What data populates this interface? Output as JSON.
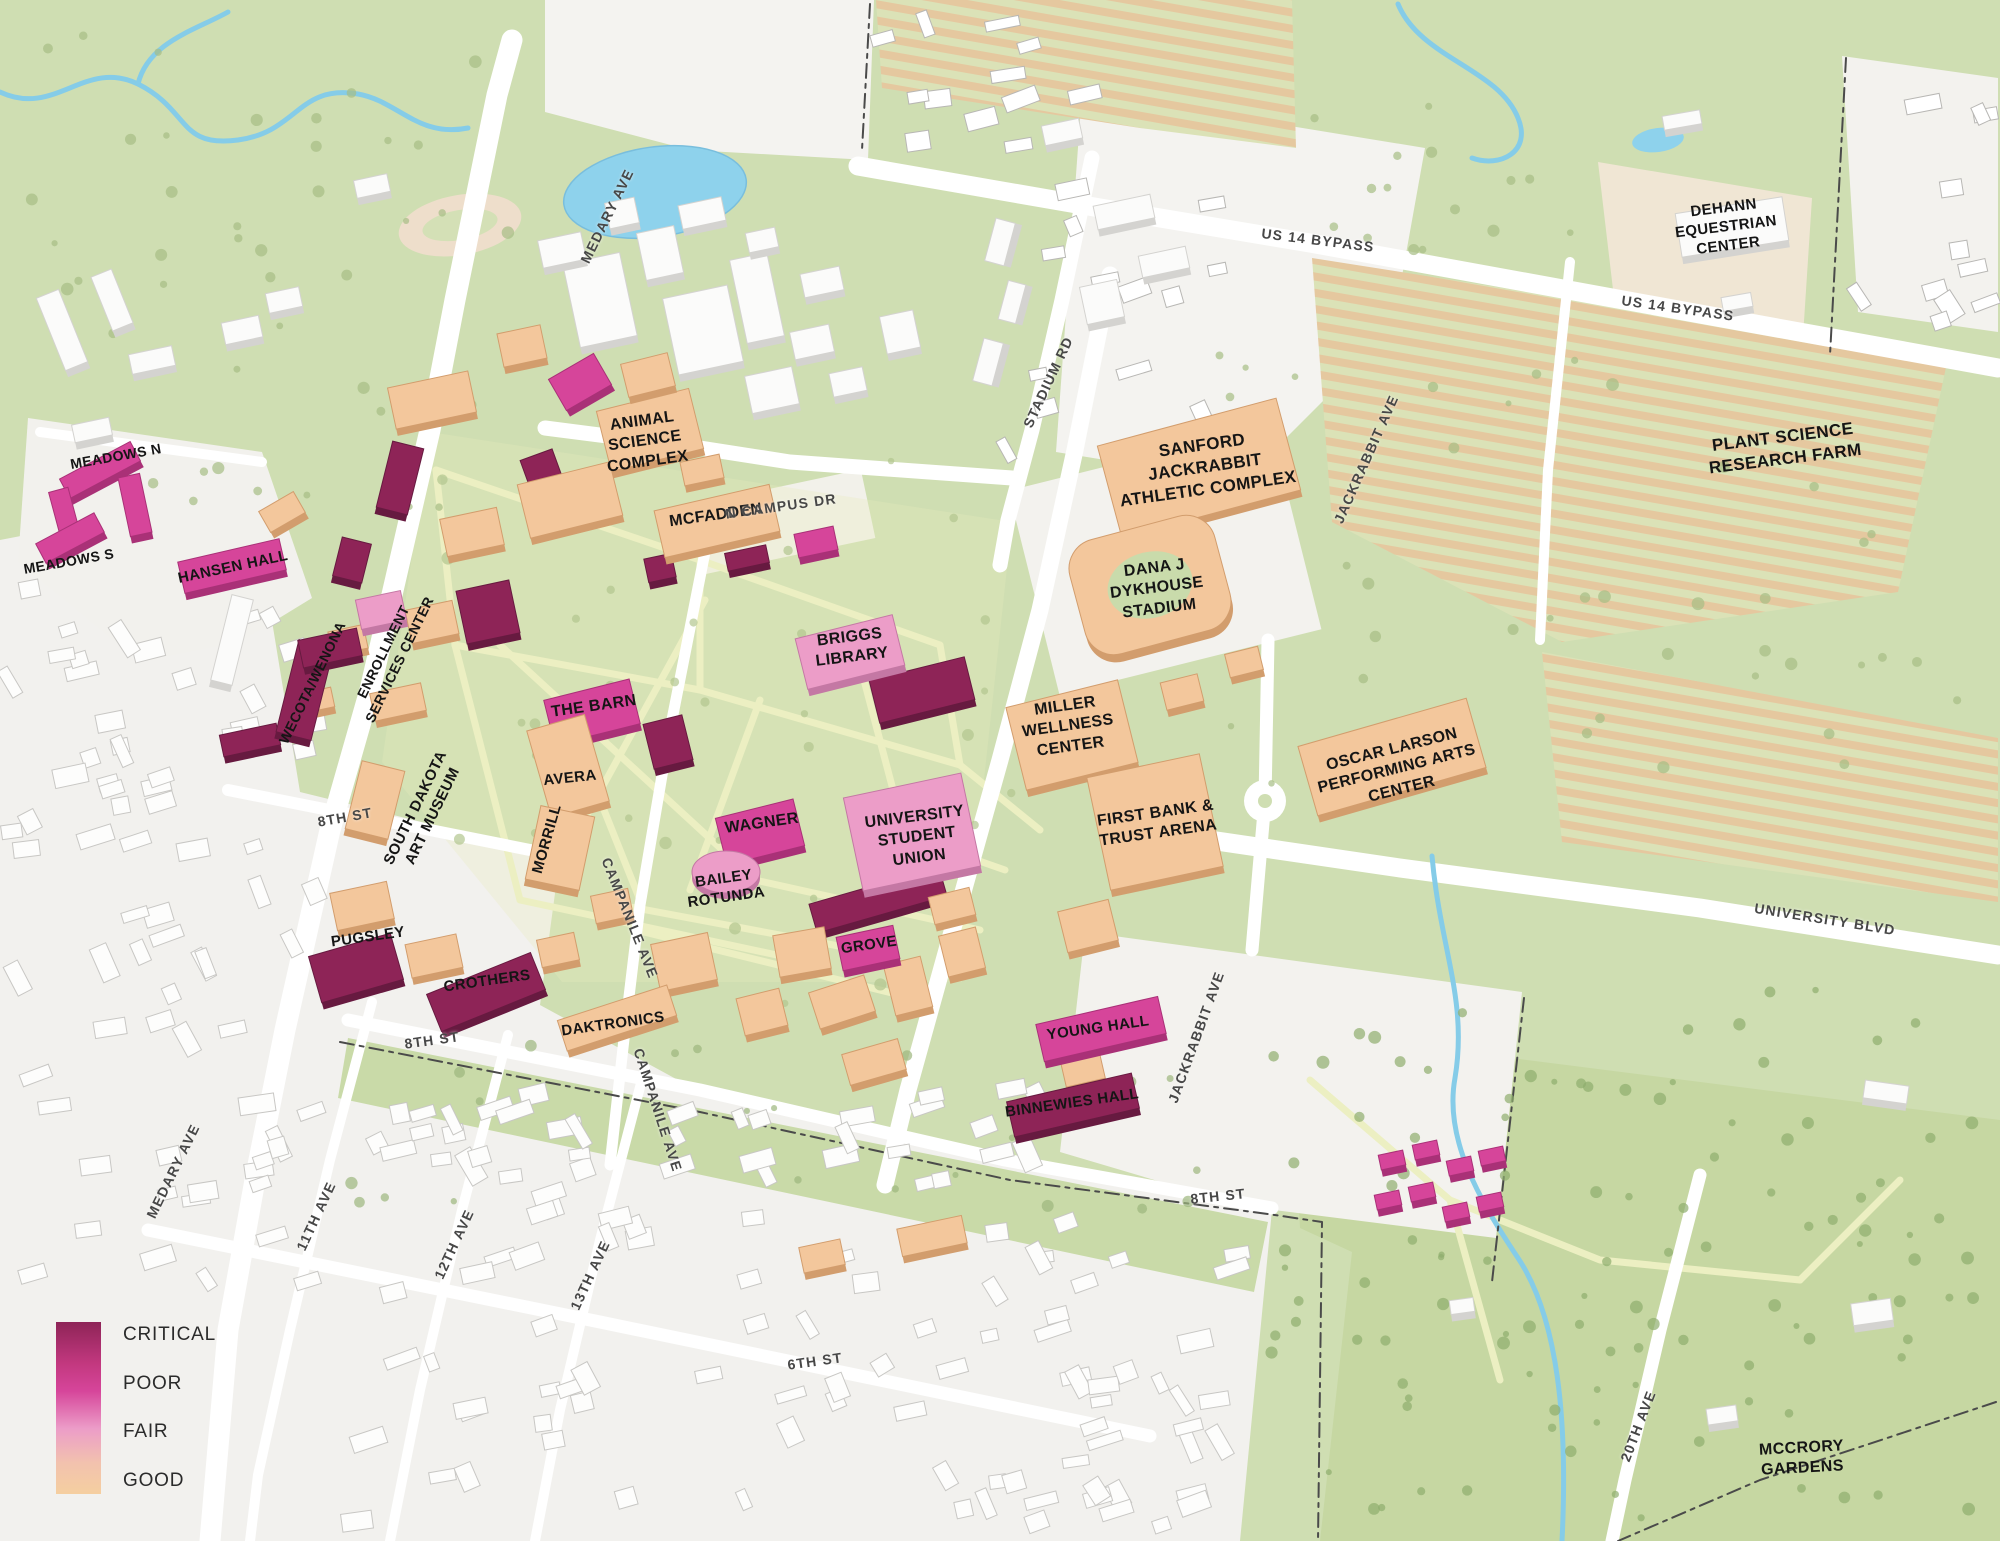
{
  "legend": {
    "items": [
      {
        "label": "CRITICAL",
        "color": "#8e2457"
      },
      {
        "label": "POOR",
        "color": "#d6459a"
      },
      {
        "label": "FAIR",
        "color": "#ec9dc8"
      },
      {
        "label": "GOOD",
        "color": "#f3c79c"
      }
    ]
  },
  "colors": {
    "critical": "#8e2457",
    "critical_side": "#671a40",
    "poor": "#d6459a",
    "poor_side": "#a93177",
    "fair": "#ec9dc8",
    "fair_side": "#c478a4",
    "good": "#f3c79c",
    "good_side": "#d29d6d",
    "white": "#fbfbfa",
    "white_side": "#d4d3d0",
    "map_green": "#cfdeb2",
    "mccrory": "#c6d7a2",
    "residential": "#f2f1ee",
    "water": "#8ed2ec",
    "road": "#ffffff",
    "path": "#ecefc2"
  },
  "buildings": [
    {
      "slug": "meadows-n",
      "label": "MEADOWS N",
      "condition": "poor",
      "label_x": 116,
      "label_y": 457,
      "label_rot": -10,
      "label_size": 14,
      "shapes": [
        [
          100,
          470,
          80,
          22,
          -28
        ],
        [
          135,
          505,
          22,
          60,
          -12
        ]
      ]
    },
    {
      "slug": "meadows-s",
      "label": "MEADOWS S",
      "condition": "poor",
      "label_x": 69,
      "label_y": 562,
      "label_rot": -10,
      "label_size": 14,
      "shapes": [
        [
          65,
          515,
          20,
          52,
          -15
        ],
        [
          70,
          538,
          66,
          22,
          -28
        ]
      ]
    },
    {
      "slug": "hansen-hall",
      "label": "HANSEN HALL",
      "condition": "poor",
      "label_x": 233,
      "label_y": 567,
      "label_rot": -12,
      "label_size": 15,
      "shapes": [
        [
          232,
          566,
          104,
          32,
          -13
        ]
      ]
    },
    {
      "slug": "wecota-wenona",
      "label": "WECOTA/WENONA",
      "condition": "critical",
      "label_x": 313,
      "label_y": 683,
      "label_rot": -64,
      "label_size": 14,
      "shapes": [
        [
          305,
          690,
          36,
          95,
          14
        ],
        [
          330,
          648,
          60,
          28,
          -12
        ]
      ]
    },
    {
      "slug": "enrollment-services-center",
      "label": "ENROLLMENT\nSERVICES CENTER",
      "condition": "fair",
      "label_x": 392,
      "label_y": 656,
      "label_rot": -64,
      "label_size": 14,
      "shapes": [
        [
          381,
          610,
          46,
          30,
          -12
        ]
      ]
    },
    {
      "slug": "south-dakota-art-museum",
      "label": "SOUTH DAKOTA\nART MUSEUM",
      "condition": "good",
      "label_x": 424,
      "label_y": 812,
      "label_rot": -64,
      "label_size": 15,
      "shapes": [
        [
          375,
          800,
          44,
          70,
          14
        ]
      ]
    },
    {
      "slug": "animal-science-complex",
      "label": "ANIMAL\nSCIENCE\nCOMPLEX",
      "condition": "good",
      "label_x": 645,
      "label_y": 442,
      "label_rot": -8,
      "label_size": 16,
      "shapes": [
        [
          650,
          430,
          95,
          62,
          -14
        ],
        [
          648,
          375,
          48,
          34,
          -14
        ],
        [
          570,
          500,
          95,
          55,
          -14
        ]
      ]
    },
    {
      "slug": "mcfadden",
      "label": "MCFADDEN",
      "condition": "good",
      "label_x": 716,
      "label_y": 516,
      "label_rot": -8,
      "label_size": 16,
      "shapes": [
        [
          717,
          521,
          118,
          48,
          -13
        ]
      ]
    },
    {
      "slug": "briggs-library",
      "label": "BRIGGS\nLIBRARY",
      "condition": "fair",
      "label_x": 851,
      "label_y": 648,
      "label_rot": -7,
      "label_size": 16,
      "shapes": [
        [
          850,
          652,
          100,
          52,
          -14
        ]
      ]
    },
    {
      "slug": "the-barn",
      "label": "THE BARN",
      "condition": "poor",
      "label_x": 594,
      "label_y": 707,
      "label_rot": -8,
      "label_size": 16,
      "shapes": [
        [
          592,
          712,
          88,
          46,
          -14
        ]
      ]
    },
    {
      "slug": "avera",
      "label": "AVERA",
      "condition": "good",
      "label_x": 570,
      "label_y": 778,
      "label_rot": -6,
      "label_size": 15,
      "shapes": [
        [
          568,
          766,
          60,
          90,
          -16
        ]
      ]
    },
    {
      "slug": "morrill",
      "label": "MORRILL",
      "condition": "good",
      "label_x": 547,
      "label_y": 839,
      "label_rot": -74,
      "label_size": 15,
      "shapes": [
        [
          560,
          848,
          55,
          75,
          12
        ]
      ]
    },
    {
      "slug": "wagner",
      "label": "WAGNER",
      "condition": "poor",
      "label_x": 762,
      "label_y": 824,
      "label_rot": -8,
      "label_size": 16,
      "shapes": [
        [
          760,
          832,
          80,
          48,
          -14
        ]
      ]
    },
    {
      "slug": "bailey-rotunda",
      "label": "BAILEY\nROTUNDA",
      "condition": "fair",
      "label_x": 725,
      "label_y": 888,
      "label_rot": -8,
      "label_size": 15,
      "ellipse": [
        726,
        872,
        34,
        21
      ]
    },
    {
      "slug": "university-student-union",
      "label": "UNIVERSITY\nSTUDENT\nUNION",
      "condition": "fair",
      "label_x": 917,
      "label_y": 838,
      "label_rot": -7,
      "label_size": 16,
      "shapes": [
        [
          912,
          832,
          120,
          95,
          -12
        ]
      ]
    },
    {
      "slug": "grove",
      "label": "GROVE",
      "condition": "poor",
      "label_x": 869,
      "label_y": 945,
      "label_rot": -8,
      "label_size": 15,
      "shapes": [
        [
          868,
          948,
          58,
          34,
          -12
        ]
      ]
    },
    {
      "slug": "pugsley",
      "label": "PUGSLEY",
      "condition": "critical",
      "label_x": 368,
      "label_y": 937,
      "label_rot": -8,
      "label_size": 15,
      "shapes": [
        [
          356,
          968,
          85,
          48,
          -16
        ]
      ]
    },
    {
      "slug": "crothers",
      "label": "CROTHERS",
      "condition": "critical",
      "label_x": 487,
      "label_y": 981,
      "label_rot": -8,
      "label_size": 15,
      "shapes": [
        [
          486,
          992,
          112,
          40,
          -22
        ]
      ]
    },
    {
      "slug": "daktronics",
      "label": "DAKTRONICS",
      "condition": "good",
      "label_x": 613,
      "label_y": 1024,
      "label_rot": -8,
      "label_size": 15,
      "shapes": [
        [
          617,
          1018,
          115,
          32,
          -18
        ]
      ]
    },
    {
      "slug": "young-hall",
      "label": "YOUNG HALL",
      "condition": "poor",
      "label_x": 1098,
      "label_y": 1028,
      "label_rot": -8,
      "label_size": 15,
      "shapes": [
        [
          1101,
          1029,
          125,
          38,
          -13
        ]
      ]
    },
    {
      "slug": "binnewies-hall",
      "label": "BINNEWIES HALL",
      "condition": "critical",
      "label_x": 1072,
      "label_y": 1103,
      "label_rot": -8,
      "label_size": 15,
      "shapes": [
        [
          1073,
          1105,
          128,
          36,
          -13
        ]
      ]
    },
    {
      "slug": "miller-wellness-center",
      "label": "MILLER\nWELLNESS\nCENTER",
      "condition": "good",
      "label_x": 1068,
      "label_y": 727,
      "label_rot": -8,
      "label_size": 16,
      "shapes": [
        [
          1072,
          735,
          115,
          85,
          -14
        ]
      ]
    },
    {
      "slug": "first-bank-trust-arena",
      "label": "FIRST BANK &\nTRUST ARENA",
      "condition": "good",
      "label_x": 1157,
      "label_y": 824,
      "label_rot": -8,
      "label_size": 16,
      "shapes": [
        [
          1155,
          822,
          115,
          115,
          -12
        ]
      ]
    },
    {
      "slug": "oscar-larson-pac",
      "label": "OSCAR LARSON\nPERFORMING ARTS\nCENTER",
      "condition": "good",
      "label_x": 1397,
      "label_y": 770,
      "label_rot": -14,
      "label_size": 16,
      "shapes": [
        [
          1392,
          757,
          175,
          72,
          -16
        ]
      ]
    },
    {
      "slug": "sanford-jackrabbit-athletic-complex",
      "label": "SANFORD\nJACKRABBIT\nATHLETIC COMPLEX",
      "condition": "good",
      "label_x": 1205,
      "label_y": 467,
      "label_rot": -8,
      "label_size": 17,
      "shapes": [
        [
          1199,
          468,
          185,
          95,
          -15
        ]
      ]
    },
    {
      "slug": "dana-j-dykhouse-stadium",
      "label": "DANA J\nDYKHOUSE\nSTADIUM",
      "condition": "good",
      "label_x": 1157,
      "label_y": 589,
      "label_rot": -7,
      "label_size": 16,
      "stadium": [
        1150,
        585,
        150,
        118,
        -15
      ]
    },
    {
      "slug": "dehann-equestrian-center",
      "label": "DEHANN\nEQUESTRIAN\nCENTER",
      "condition": "white",
      "label_x": 1726,
      "label_y": 227,
      "label_rot": -7,
      "label_size": 15,
      "shapes": [
        [
          1732,
          227,
          108,
          44,
          -9
        ]
      ]
    }
  ],
  "areas": [
    {
      "slug": "plant-science-research-farm",
      "label": "PLANT SCIENCE\nRESEARCH FARM",
      "x": 1784,
      "y": 448,
      "rot": -7,
      "size": 17
    },
    {
      "slug": "mccrory-gardens",
      "label": "MCCRORY\nGARDENS",
      "x": 1802,
      "y": 1459,
      "rot": -3,
      "size": 16
    }
  ],
  "streets": [
    {
      "slug": "medary-ave-north",
      "name": "MEDARY AVE",
      "x": 607,
      "y": 216,
      "rot": -64
    },
    {
      "slug": "medary-ave-south",
      "name": "MEDARY AVE",
      "x": 173,
      "y": 1171,
      "rot": -64
    },
    {
      "slug": "n-campus-dr",
      "name": "N CAMPUS DR",
      "x": 781,
      "y": 506,
      "rot": -8
    },
    {
      "slug": "stadium-rd",
      "name": "STADIUM RD",
      "x": 1048,
      "y": 382,
      "rot": -65
    },
    {
      "slug": "jackrabbit-ave-north",
      "name": "JACKRABBIT AVE",
      "x": 1366,
      "y": 459,
      "rot": -66
    },
    {
      "slug": "jackrabbit-ave-south",
      "name": "JACKRABBIT AVE",
      "x": 1196,
      "y": 1037,
      "rot": -70
    },
    {
      "slug": "us-14-bypass-west",
      "name": "US 14 BYPASS",
      "x": 1318,
      "y": 240,
      "rot": 7
    },
    {
      "slug": "us-14-bypass-east",
      "name": "US 14 BYPASS",
      "x": 1678,
      "y": 308,
      "rot": 8
    },
    {
      "slug": "university-blvd",
      "name": "UNIVERSITY BLVD",
      "x": 1825,
      "y": 919,
      "rot": 9
    },
    {
      "slug": "campanile-ave-north",
      "name": "CAMPANILE AVE",
      "x": 630,
      "y": 918,
      "rot": 68
    },
    {
      "slug": "campanile-ave-south",
      "name": "CAMPANILE AVE",
      "x": 658,
      "y": 1110,
      "rot": 72
    },
    {
      "slug": "8th-st-west",
      "name": "8TH ST",
      "x": 345,
      "y": 817,
      "rot": -10
    },
    {
      "slug": "8th-st-mid",
      "name": "8TH ST",
      "x": 432,
      "y": 1040,
      "rot": -8
    },
    {
      "slug": "8th-st-east",
      "name": "8TH ST",
      "x": 1218,
      "y": 1196,
      "rot": -6
    },
    {
      "slug": "6th-st",
      "name": "6TH ST",
      "x": 815,
      "y": 1361,
      "rot": -8
    },
    {
      "slug": "11th-ave",
      "name": "11TH AVE",
      "x": 316,
      "y": 1216,
      "rot": -65
    },
    {
      "slug": "12th-ave",
      "name": "12TH AVE",
      "x": 454,
      "y": 1244,
      "rot": -65
    },
    {
      "slug": "13th-ave",
      "name": "13TH AVE",
      "x": 590,
      "y": 1275,
      "rot": -65
    },
    {
      "slug": "20th-ave",
      "name": "20TH AVE",
      "x": 1638,
      "y": 1426,
      "rot": -69
    }
  ]
}
